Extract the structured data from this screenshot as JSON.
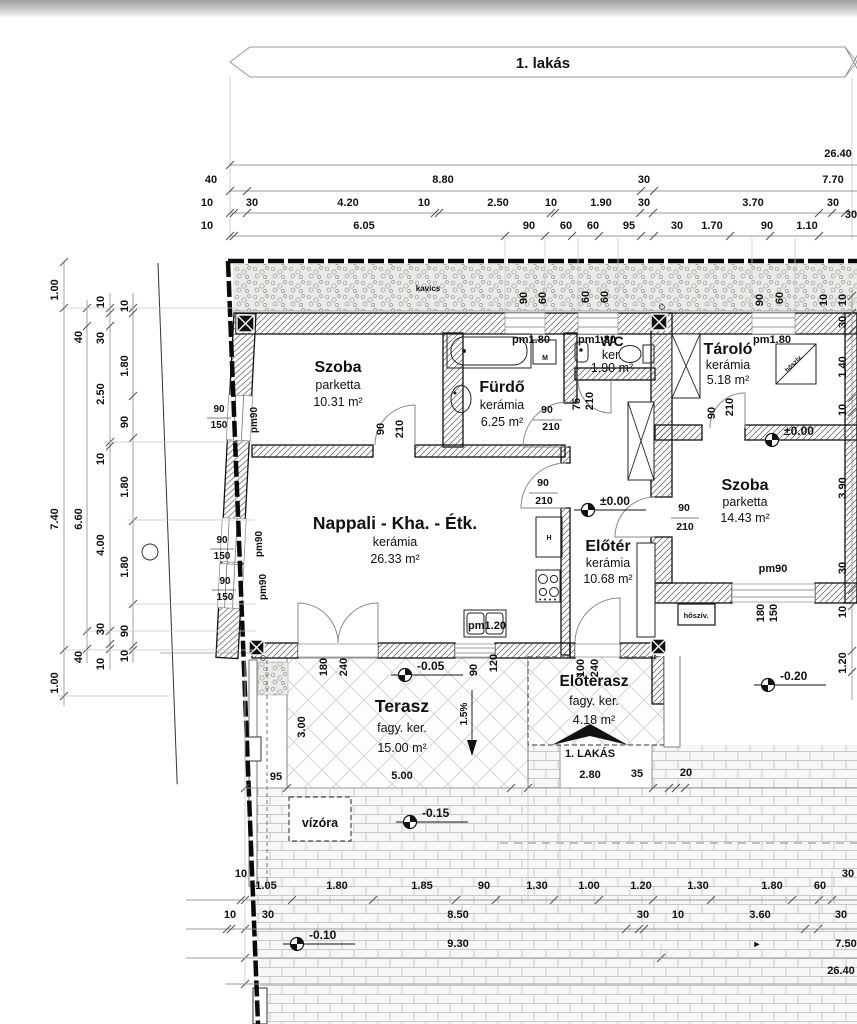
{
  "banner": {
    "label": "1. lakás"
  },
  "rooms": [
    {
      "name": "Szoba",
      "material": "parketta",
      "area": "10.31 m²",
      "x": 338,
      "y": 372,
      "ns": 16,
      "lh": 17
    },
    {
      "name": "Fürdő",
      "material": "kerámia",
      "area": "6.25 m²",
      "x": 502,
      "y": 392,
      "ns": 16,
      "lh": 17
    },
    {
      "name": "WC",
      "material": "ker.",
      "area": "1.90 m²",
      "x": 612,
      "y": 346,
      "ns": 14,
      "lh": 13
    },
    {
      "name": "Tároló",
      "material": "kerámia",
      "area": "5.18 m²",
      "x": 728,
      "y": 354,
      "ns": 16,
      "lh": 15
    },
    {
      "name": "Szoba",
      "material": "parketta",
      "area": "14.43 m²",
      "x": 745,
      "y": 490,
      "ns": 16,
      "lh": 16
    },
    {
      "name": "Nappali - Kha. - Étk.",
      "material": "kerámia",
      "area": "26.33 m²",
      "x": 395,
      "y": 529,
      "ns": 17.5,
      "lh": 17
    },
    {
      "name": "Előtér",
      "material": "kerámia",
      "area": "10.68 m²",
      "x": 608,
      "y": 551,
      "ns": 16,
      "lh": 16
    },
    {
      "name": "Terasz",
      "material": "fagy. ker.",
      "area": "15.00 m²",
      "x": 402,
      "y": 712,
      "ns": 17.5,
      "lh": 20
    },
    {
      "name": "Előterasz",
      "material": "fagy. ker.",
      "area": "4.18 m²",
      "x": 594,
      "y": 686,
      "ns": 15.5,
      "lh": 19
    }
  ],
  "levels": [
    {
      "text": "±0.00",
      "mx": 588,
      "my": 510
    },
    {
      "text": "±0.00",
      "mx": 772,
      "my": 440
    },
    {
      "text": "-0.05",
      "mx": 405,
      "my": 675
    },
    {
      "text": "-0.20",
      "mx": 768,
      "my": 685
    },
    {
      "text": "-0.15",
      "mx": 410,
      "my": 822
    },
    {
      "text": "-0.10",
      "mx": 297,
      "my": 944
    }
  ],
  "entrance": {
    "label": "1. LAKÁS"
  },
  "annotations": [
    {
      "t": "26.40",
      "x": 838,
      "y": 157
    },
    {
      "t": "40",
      "x": 211,
      "y": 183
    },
    {
      "t": "8.80",
      "x": 443,
      "y": 183
    },
    {
      "t": "30",
      "x": 644,
      "y": 183
    },
    {
      "t": "7.70",
      "x": 833,
      "y": 183
    },
    {
      "t": "10",
      "x": 207,
      "y": 206
    },
    {
      "t": "30",
      "x": 252,
      "y": 206
    },
    {
      "t": "4.20",
      "x": 348,
      "y": 206
    },
    {
      "t": "10",
      "x": 424,
      "y": 206
    },
    {
      "t": "2.50",
      "x": 498,
      "y": 206
    },
    {
      "t": "10",
      "x": 551,
      "y": 206
    },
    {
      "t": "1.90",
      "x": 601,
      "y": 206
    },
    {
      "t": "30",
      "x": 644,
      "y": 206
    },
    {
      "t": "3.70",
      "x": 753,
      "y": 206
    },
    {
      "t": "30",
      "x": 833,
      "y": 206
    },
    {
      "t": "30",
      "x": 851,
      "y": 218
    },
    {
      "t": "10",
      "x": 207,
      "y": 229
    },
    {
      "t": "6.05",
      "x": 364,
      "y": 229
    },
    {
      "t": "90",
      "x": 529,
      "y": 229
    },
    {
      "t": "60",
      "x": 566,
      "y": 229
    },
    {
      "t": "60",
      "x": 593,
      "y": 229
    },
    {
      "t": "95",
      "x": 629,
      "y": 229
    },
    {
      "t": "30",
      "x": 677,
      "y": 229
    },
    {
      "t": "1.70",
      "x": 712,
      "y": 229
    },
    {
      "t": "90",
      "x": 767,
      "y": 229
    },
    {
      "t": "1.10",
      "x": 807,
      "y": 229
    },
    {
      "t": "1.00",
      "x": 58,
      "y": 290,
      "r": -90
    },
    {
      "t": "7.40",
      "x": 58,
      "y": 519,
      "r": -90
    },
    {
      "t": "1.00",
      "x": 58,
      "y": 683,
      "r": -90
    },
    {
      "t": "40",
      "x": 82,
      "y": 337,
      "r": -90
    },
    {
      "t": "6.60",
      "x": 82,
      "y": 519,
      "r": -90
    },
    {
      "t": "40",
      "x": 82,
      "y": 657,
      "r": -90
    },
    {
      "t": "10",
      "x": 104,
      "y": 302,
      "r": -90
    },
    {
      "t": "30",
      "x": 104,
      "y": 338,
      "r": -90
    },
    {
      "t": "2.50",
      "x": 104,
      "y": 394,
      "r": -90
    },
    {
      "t": "10",
      "x": 104,
      "y": 459,
      "r": -90
    },
    {
      "t": "4.00",
      "x": 104,
      "y": 545,
      "r": -90
    },
    {
      "t": "30",
      "x": 104,
      "y": 629,
      "r": -90
    },
    {
      "t": "10",
      "x": 104,
      "y": 664,
      "r": -90
    },
    {
      "t": "10",
      "x": 128,
      "y": 306,
      "r": -90
    },
    {
      "t": "1.80",
      "x": 128,
      "y": 366,
      "r": -90
    },
    {
      "t": "90",
      "x": 128,
      "y": 422,
      "r": -90
    },
    {
      "t": "1.80",
      "x": 128,
      "y": 487,
      "r": -90
    },
    {
      "t": "1.80",
      "x": 128,
      "y": 567,
      "r": -90
    },
    {
      "t": "90",
      "x": 128,
      "y": 631,
      "r": -90
    },
    {
      "t": "10",
      "x": 128,
      "y": 656,
      "r": -90
    },
    {
      "t": "10",
      "x": 846,
      "y": 300,
      "r": -90
    },
    {
      "t": "30",
      "x": 846,
      "y": 322,
      "r": -90
    },
    {
      "t": "1.40",
      "x": 846,
      "y": 367,
      "r": -90
    },
    {
      "t": "10",
      "x": 846,
      "y": 410,
      "r": -90
    },
    {
      "t": "3.90",
      "x": 846,
      "y": 488,
      "r": -90
    },
    {
      "t": "30",
      "x": 846,
      "y": 568,
      "r": -90
    },
    {
      "t": "10",
      "x": 846,
      "y": 612,
      "r": -90
    },
    {
      "t": "1.20",
      "x": 846,
      "y": 663,
      "r": -90
    },
    {
      "t": "90",
      "x": 527,
      "y": 298,
      "r": -90
    },
    {
      "t": "60",
      "x": 546,
      "y": 298,
      "r": -90
    },
    {
      "t": "60",
      "x": 589,
      "y": 297,
      "r": -90
    },
    {
      "t": "60",
      "x": 608,
      "y": 297,
      "r": -90
    },
    {
      "t": "90",
      "x": 763,
      "y": 300,
      "r": -90
    },
    {
      "t": "60",
      "x": 783,
      "y": 298,
      "r": -90
    },
    {
      "t": "10",
      "x": 827,
      "y": 300,
      "r": -90
    },
    {
      "t": "pm90",
      "x": 257,
      "y": 420,
      "r": -90,
      "s": 10
    },
    {
      "t": "pm90",
      "x": 262,
      "y": 544,
      "r": -90,
      "s": 10
    },
    {
      "t": "pm90",
      "x": 266,
      "y": 587,
      "r": -90,
      "s": 10
    },
    {
      "t": "90",
      "x": 219,
      "y": 412,
      "s": 10
    },
    {
      "t": "150",
      "x": 219,
      "y": 428,
      "s": 10
    },
    {
      "t": "90",
      "x": 222,
      "y": 543,
      "s": 10
    },
    {
      "t": "150",
      "x": 222,
      "y": 559,
      "s": 10
    },
    {
      "t": "90",
      "x": 225,
      "y": 584,
      "s": 10
    },
    {
      "t": "150",
      "x": 225,
      "y": 600,
      "s": 10
    },
    {
      "t": "pm1.80",
      "x": 531,
      "y": 343
    },
    {
      "t": "pm1.80",
      "x": 597,
      "y": 343
    },
    {
      "t": "pm1.80",
      "x": 772,
      "y": 343
    },
    {
      "t": "pm90",
      "x": 773,
      "y": 572
    },
    {
      "t": "pm1.20",
      "x": 487,
      "y": 629
    },
    {
      "t": "M",
      "x": 545,
      "y": 360,
      "s": 7
    },
    {
      "t": "H",
      "x": 549,
      "y": 540,
      "s": 7
    },
    {
      "t": "90",
      "x": 384,
      "y": 429,
      "r": -90
    },
    {
      "t": "210",
      "x": 403,
      "y": 429,
      "r": -90
    },
    {
      "t": "75",
      "x": 580,
      "y": 404,
      "r": -90
    },
    {
      "t": "210",
      "x": 593,
      "y": 401,
      "r": -90
    },
    {
      "t": "90",
      "x": 715,
      "y": 413,
      "r": -90
    },
    {
      "t": "210",
      "x": 733,
      "y": 407,
      "r": -90
    },
    {
      "t": "180",
      "x": 327,
      "y": 667,
      "r": -90
    },
    {
      "t": "240",
      "x": 347,
      "y": 667,
      "r": -90
    },
    {
      "t": "90",
      "x": 477,
      "y": 670,
      "r": -90
    },
    {
      "t": "120",
      "x": 497,
      "y": 663,
      "r": -90
    },
    {
      "t": "100",
      "x": 584,
      "y": 668,
      "r": -90
    },
    {
      "t": "240",
      "x": 598,
      "y": 668,
      "r": -90
    },
    {
      "t": "180",
      "x": 764,
      "y": 613,
      "r": -90
    },
    {
      "t": "150",
      "x": 777,
      "y": 613,
      "r": -90
    },
    {
      "t": "90",
      "x": 547,
      "y": 413,
      "s": 10.5
    },
    {
      "t": "210",
      "x": 551,
      "y": 430,
      "s": 10.5
    },
    {
      "t": "90",
      "x": 543,
      "y": 486,
      "s": 10.5
    },
    {
      "t": "210",
      "x": 544,
      "y": 504,
      "s": 10.5
    },
    {
      "t": "90",
      "x": 684,
      "y": 511,
      "s": 10.5
    },
    {
      "t": "210",
      "x": 685,
      "y": 530,
      "s": 10.5
    },
    {
      "t": "kavics",
      "x": 428,
      "y": 291,
      "s": 8
    },
    {
      "t": "vízóra",
      "x": 320,
      "y": 827,
      "s": 12.5
    },
    {
      "t": "hőszív.",
      "x": 696,
      "y": 618,
      "s": 7.5
    },
    {
      "t": "hőszív.",
      "x": 795,
      "y": 365,
      "r": -45,
      "s": 6.5
    },
    {
      "t": "1.5%",
      "x": 467,
      "y": 714,
      "r": -90,
      "s": 10
    },
    {
      "t": "►",
      "x": 757,
      "y": 947,
      "s": 9
    },
    {
      "t": "3.00",
      "x": 305,
      "y": 727,
      "r": -90
    },
    {
      "t": "95",
      "x": 276,
      "y": 780
    },
    {
      "t": "5.00",
      "x": 402,
      "y": 779
    },
    {
      "t": "2.80",
      "x": 590,
      "y": 778
    },
    {
      "t": "35",
      "x": 637,
      "y": 777
    },
    {
      "t": "20",
      "x": 686,
      "y": 776
    },
    {
      "t": "10",
      "x": 241,
      "y": 877
    },
    {
      "t": "1.05",
      "x": 266,
      "y": 889
    },
    {
      "t": "1.80",
      "x": 337,
      "y": 889
    },
    {
      "t": "1.85",
      "x": 422,
      "y": 889
    },
    {
      "t": "90",
      "x": 484,
      "y": 889
    },
    {
      "t": "1.30",
      "x": 537,
      "y": 889
    },
    {
      "t": "1.00",
      "x": 589,
      "y": 889
    },
    {
      "t": "1.20",
      "x": 641,
      "y": 889
    },
    {
      "t": "1.30",
      "x": 698,
      "y": 889
    },
    {
      "t": "1.80",
      "x": 772,
      "y": 889
    },
    {
      "t": "60",
      "x": 820,
      "y": 889
    },
    {
      "t": "30",
      "x": 848,
      "y": 877
    },
    {
      "t": "10",
      "x": 230,
      "y": 918
    },
    {
      "t": "30",
      "x": 268,
      "y": 918
    },
    {
      "t": "8.50",
      "x": 458,
      "y": 918
    },
    {
      "t": "30",
      "x": 643,
      "y": 918
    },
    {
      "t": "10",
      "x": 678,
      "y": 918
    },
    {
      "t": "3.60",
      "x": 760,
      "y": 918
    },
    {
      "t": "30",
      "x": 841,
      "y": 918
    },
    {
      "t": "9.30",
      "x": 458,
      "y": 947
    },
    {
      "t": "7.50",
      "x": 846,
      "y": 947
    },
    {
      "t": "26.40",
      "x": 841,
      "y": 974
    }
  ]
}
